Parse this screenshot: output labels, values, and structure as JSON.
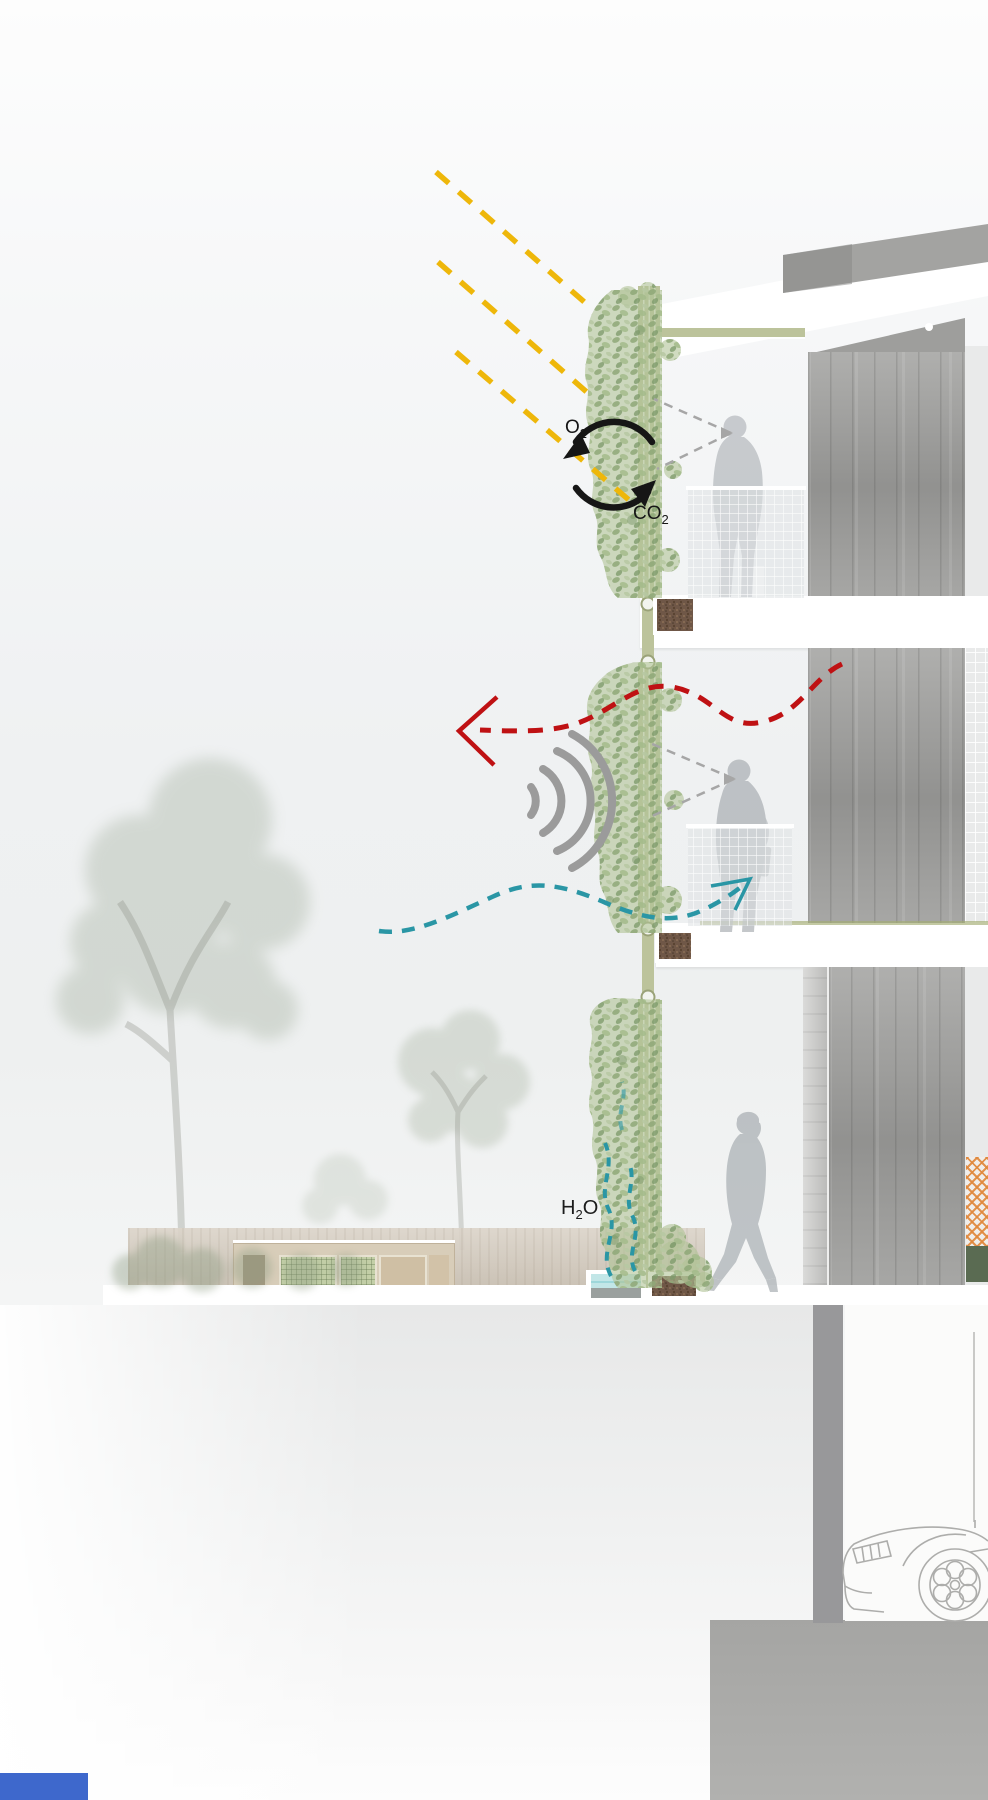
{
  "labels": {
    "o2": {
      "main": "O",
      "sub": "2"
    },
    "co2": {
      "main": "CO",
      "sub": "2"
    },
    "h2o": {
      "h": "H",
      "sub": "2",
      "o": "O"
    }
  },
  "colors": {
    "sun_ray": "#eeb70a",
    "heat_arrow": "#bf1113",
    "air_arrow": "#2a96a5",
    "sound_wave": "#9b9b9b",
    "gas_cycle": "#161616",
    "sight_line": "#a6a6a6",
    "facade_frame": "#bcc39b",
    "soil": "#6f5747",
    "water": "#c2e6e7",
    "concrete": "#a2a2a0",
    "ground_wall": "#cec4b5",
    "bottom_bar": "#3e68cc"
  },
  "icons": {
    "sun_rays": "diagonal-dashed-lines",
    "oxygen_cycle": "circular-arrows",
    "heat_reflection": "wavy-dashed-arrow-left",
    "sound_absorption": "nested-arcs",
    "cool_airflow": "wavy-dashed-arrow-right",
    "evaporation": "rising-dashed-squiggles",
    "sight_cone": "dashed-view-lines"
  }
}
